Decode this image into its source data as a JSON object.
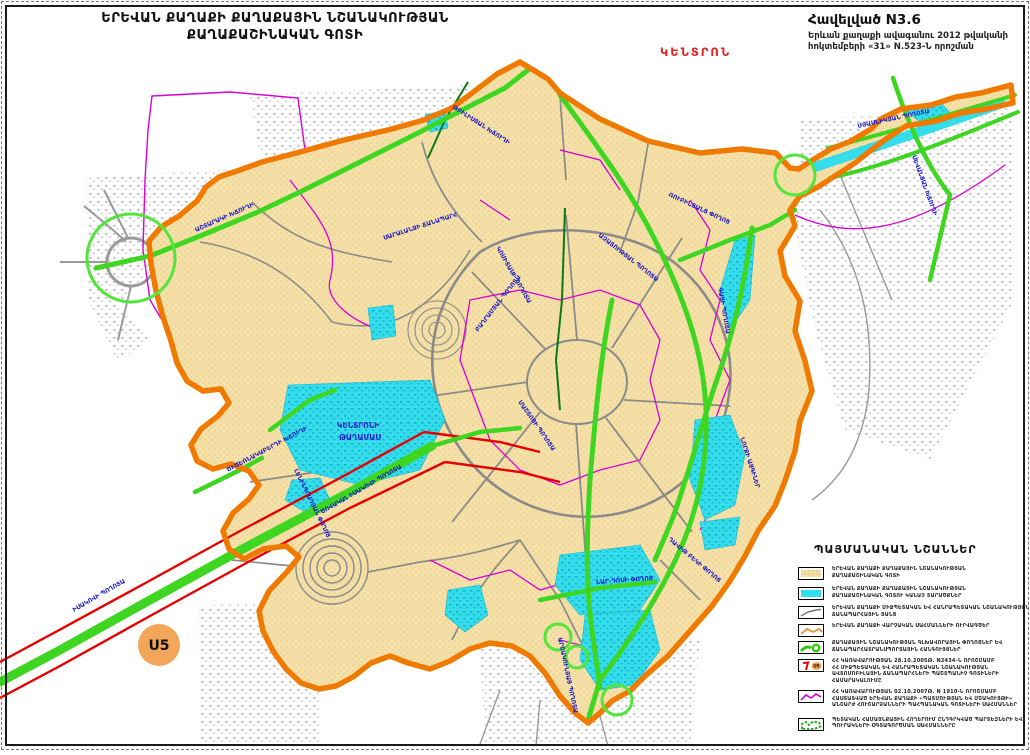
{
  "header": {
    "title_line1": "ԵՐԵՎԱՆ ՔԱՂԱՔԻ ՔԱՂԱՔԱՅԻՆ ՆՇԱՆԱԿՈՒԹՅԱՆ",
    "title_line2": "ՔԱՂԱՔԱՇԻՆԱԿԱՆ ԳՈՏԻ",
    "appendix": {
      "title": "Հավելված N3.6",
      "line1": "Երևան քաղաքի ավագանու 2012 թվականի",
      "line2": "հոկտեմբերի «31» N.523-Ն   որոշման"
    },
    "district_banner": "ԿԵՆՏՐՈՆ"
  },
  "map": {
    "u5_label": "U5",
    "district_area_label": {
      "line1": "ԿԵՆՏՐՈՆԻ",
      "line2": "ԹԱՂԱՄԱՍ"
    },
    "labels": [
      {
        "text": "ԱՇՏԱՐԱԿԻ ԽՃՈՒՂԻ",
        "x": 196,
        "y": 232,
        "r": -24
      },
      {
        "text": "ԹԲԻԼԻՍՅԱՆ ԽՃՈՒՂԻ",
        "x": 452,
        "y": 108,
        "r": 33
      },
      {
        "text": "ՄՅԱՍՆԻԿՅԱՆ ՊՈՂՈՏԱ",
        "x": 858,
        "y": 128,
        "r": -12
      },
      {
        "text": "ՍԵՎԱՆՅԱՆ ԽՃՈՒՂԻ",
        "x": 912,
        "y": 156,
        "r": 70
      },
      {
        "text": "ԻՍԱԿՈՎԻ ՊՈՂՈՏԱ",
        "x": 74,
        "y": 612,
        "r": -30
      },
      {
        "text": "ԾՈՎԱԿԱԼ ԻՍԱԿՈՎԻ ՊՈՂՈՏԱ",
        "x": 322,
        "y": 514,
        "r": -30
      },
      {
        "text": "ԱՐՇԱԿՈՒՆՅԱՑ ՊՈՂՈՏԱ",
        "x": 558,
        "y": 638,
        "r": 78
      },
      {
        "text": "ԳԱՅԻ ՊՈՂՈՏԱ",
        "x": 718,
        "y": 288,
        "r": 80
      },
      {
        "text": "ԱԶԱՏՈՒԹՅԱՆ ՊՈՂՈՏԱ",
        "x": 598,
        "y": 236,
        "r": 38
      },
      {
        "text": "ԿՈՄԻՏԱՍԻ ՊՈՂՈՏԱ",
        "x": 496,
        "y": 248,
        "r": 60
      },
      {
        "text": "ԲԱՂՐԱՄՅԱՆ ՊՈՂՈՏԱ",
        "x": 478,
        "y": 332,
        "r": -52
      },
      {
        "text": "ՄԱՇՏՈՑԻ ՊՈՂՈՏԱ",
        "x": 518,
        "y": 402,
        "r": 55
      },
      {
        "text": "ՆԱՐ-ԴՈՍԻ ՓՈՂՈՑ",
        "x": 596,
        "y": 584,
        "r": -4
      },
      {
        "text": "ՆՈՐՔԻ ԱՅԳԻՆԵՐ",
        "x": 740,
        "y": 438,
        "r": 72
      },
      {
        "text": "ԾԻԾԵՌՆԱԿԱԲԵՐԴԻ ԽՃՈՒՂԻ",
        "x": 228,
        "y": 472,
        "r": -28
      },
      {
        "text": "ԴԱՎԻԹ ԲԵԿԻ ՓՈՂՈՑ",
        "x": 668,
        "y": 540,
        "r": 40
      },
      {
        "text": "ՌՈՒԲԻՆՅԱՆՑ ՓՈՂՈՑ",
        "x": 668,
        "y": 196,
        "r": 25
      },
      {
        "text": "ԼԵՆԻՆԳՐԱԴՅԱՆ ՓՈՂՈՑ",
        "x": 294,
        "y": 470,
        "r": 64
      },
      {
        "text": "ՍԱՐԱԼԱՆՋԻ ՃԱՆԱՊԱՐՀ",
        "x": 384,
        "y": 240,
        "r": -18
      }
    ]
  },
  "legend": {
    "title": "ՊԱՅՄԱՆԱԿԱՆ ՆՇԱՆՆԵՐ",
    "rows": [
      {
        "swatch": "zone-fill",
        "lines": [
          "ԵՐԵՎԱՆ ՔԱՂԱՔԻ ՔԱՂԱՔԱՅԻՆ ՆՇԱՆԱԿՈՒԹՅԱՆ",
          "ՔԱՂԱՔԱՇԻՆԱԿԱՆ ԳՈՏԻ"
        ]
      },
      {
        "swatch": "green-area-fill",
        "lines": [
          "ԵՐԵՎԱՆ ՔԱՂԱՔԻ ՔԱՂԱՔԱՅԻՆ ՆՇԱՆԱԿՈՒԹՅԱՆ",
          "ՔԱՂԱՔԱՇԻՆԱԿԱՆ ԳՈՏՈՒ ԿԱՆԱՉ ՏԱՐԱԾՔՆԵՐ"
        ]
      },
      {
        "swatch": "road-line",
        "lines": [
          "ԵՐԵՎԱՆ ՔԱՂԱՔԻ ՄԻՋՊԵՏԱԿԱՆ ԵՎ ՀԱՆՐԱՊԵՏԱԿԱՆ ՆՇԱՆԱԿՈՒԹՅԱՆ",
          "ՃԱՆԱՊԱՐՀԱՅԻՆ ՑԱՆՑ"
        ]
      },
      {
        "swatch": "admin-boundary-line",
        "lines": [
          "ԵՐԵՎԱՆ ՔԱՂԱՔԻ ՎԱՐՉԱԿԱՆ ՍԱՀՄԱՆՆԵՐԻ ՈՒՐՎԱԳԾԵՐ"
        ]
      },
      {
        "swatch": "green-road",
        "lines": [
          "ՔԱՂԱՔԱՅԻՆ ՆՇԱՆԱԿՈՒԹՅԱՆ ԳԼԽԱՎՈՐԱՅԻՆ ՓՈՂՈՑՆԵՐ ԵՎ",
          "ՃԱՆԱՊԱՐՀԱՏՐԱՆՍՊՈՐՏԱՅԻՆ ՀԱՆԳՈՒՅՑՆԵՐ"
        ]
      },
      {
        "swatch": "highway-u5",
        "lines": [
          "ՀՀ ԿԱՌԱՎԱՐՈՒԹՅԱՆ 28.10.2005Թ. N2434-Ն ՈՐՈՇՄԱՄԲ",
          "ՀՀ ՄԻՋՊԵՏԱԿԱՆ ԵՎ ՀԱՆՐԱՊԵՏԱԿԱՆ ՆՇԱՆԱԿՈՒԹՅԱՆ",
          "ԱՎՏՈՄՈԲԻԼԱՅԻՆ ՃԱՆԱՊԱՐՀՆԵՐԻ ՊԱՇՏՊԱՆԻՉ ԳՈՏԻՆԵՐԻ",
          "ՀԱՄԱՐԱԿԱԼՈՒՄԸ"
        ]
      },
      {
        "swatch": "monument-zone-line",
        "lines": [
          "ՀՀ ԿԱՌԱՎԱՐՈՒԹՅԱՆ 02.10.2007Թ. N 1910-Ն ՈՐՈՇՄԱՄԲ",
          "ՀԱՍՏԱՏՎԱԾ ԵՐԵՎԱՆ ՔԱՂԱՔԻ «ՊԱՏՄՈՒԹՅԱՆ ԵՎ ՄՇԱԿՈՒՅԹԻ»",
          "ԱՆՇԱՐԺ ՀՈՒՇԱՐՁԱՆՆԵՐԻ ՊԱՀՊԱՆԱԿԱՆ ԳՈՏԻՆԵՐԻ ՍԱՀՄԱՆՆԵՐ"
        ]
      },
      {
        "swatch": "park-boundary",
        "lines": [
          "ՊԵՏԱԿԱՆ ՀԱՄԱՅՆՔԱՅԻՆ ՀՈՂԵՐՈՒՄ ԸՆԴԳՐԿՎԱԾ ՊԱՐՏԵԶՆԵՐԻ ԵՎ",
          "ՊՈՒՐԱԿՆԵՐԻ ՕԳՏԱԳՈՐԾՄԱՆ ՍԱՀՄԱՆՆԵՐԸ"
        ]
      }
    ]
  },
  "colors": {
    "boundary_orange": "#F07A00",
    "zone_tan": "#F5E1A8",
    "green_area_cyan": "#35DCEA",
    "main_street_green": "#3FD622",
    "node_circle_green": "#52E53A",
    "highway_red": "#E60000",
    "monument_magenta": "#D800D8",
    "road_gray": "#8A8A8A",
    "label_blue": "#1818C8",
    "banner_red": "#E02222",
    "u5_badge_orange": "#F2A65A"
  }
}
